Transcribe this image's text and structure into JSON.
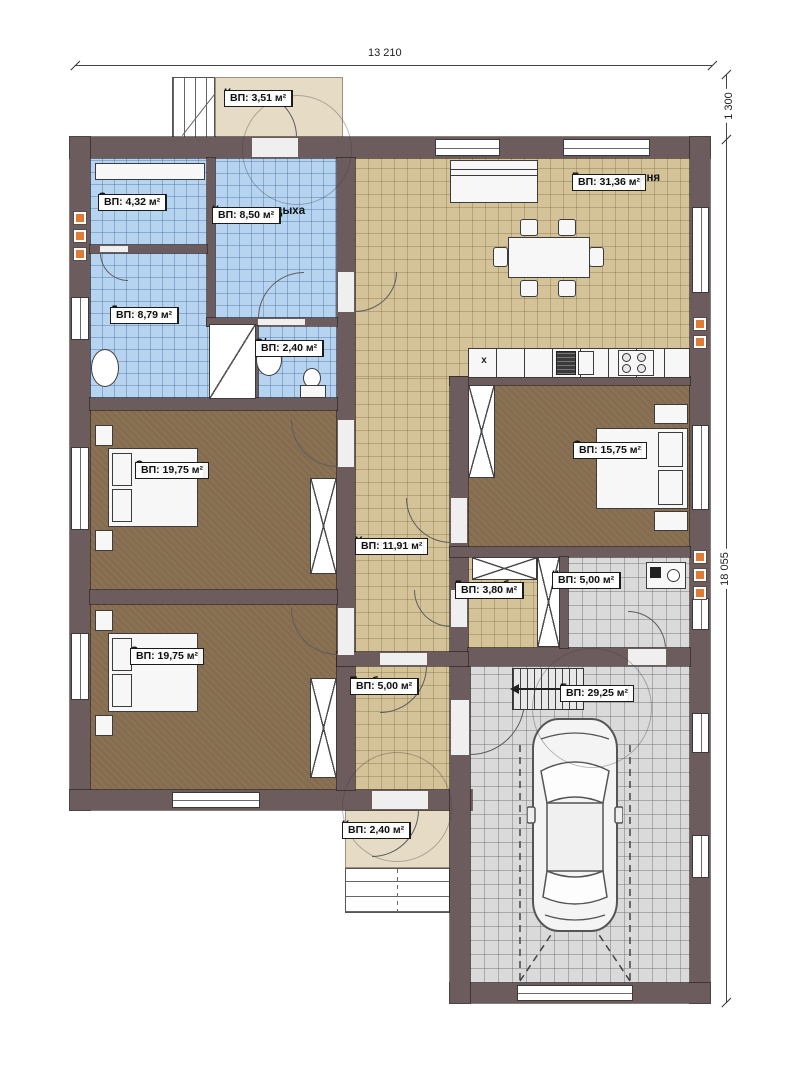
{
  "dims": {
    "top": "13 210",
    "right_top": "1 300",
    "right_main": "18 055"
  },
  "kitchen": {
    "counter_mark": "x"
  },
  "rooms": [
    {
      "name": "Крыльцо",
      "brand": "FixPlans.ru",
      "area": "ВП: 3,51 м²"
    },
    {
      "name": "Сауна",
      "brand": "FixPlans.ru",
      "area": "ВП: 4,32 м²"
    },
    {
      "name": "Комната отдыха",
      "brand": "FixPlans.ru",
      "area": "ВП: 8,50 м²"
    },
    {
      "name": "Душевая",
      "brand": "FixPlans.ru",
      "area": "ВП: 8,79 м²"
    },
    {
      "name": "С/у",
      "brand": "FixPlans.ru",
      "area": "ВП: 2,40 м²"
    },
    {
      "name": "Гостиная-кухня",
      "brand": "FixPlans.ru",
      "area": "ВП: 31,36 м²"
    },
    {
      "name": "Спальня",
      "brand": "FixPlans.ru",
      "area": "ВП: 19,75 м²"
    },
    {
      "name": "Холл",
      "brand": "FixPlans.ru",
      "area": "ВП: 11,91 м²"
    },
    {
      "name": "Спальня",
      "brand": "FixPlans.ru",
      "area": "ВП: 15,75 м²"
    },
    {
      "name": "Гардероб",
      "brand": "FixPlans.ru",
      "area": "ВП: 3,80 м²"
    },
    {
      "name": "Котельная",
      "brand": "FixPlans.ru",
      "area": "ВП: 5,00 м²"
    },
    {
      "name": "Спальня",
      "brand": "FixPlans.ru",
      "area": "ВП: 19,75 м²"
    },
    {
      "name": "Тамбур",
      "brand": "FixPlans.ru",
      "area": "ВП: 5,00 м²"
    },
    {
      "name": "Гараж",
      "brand": "FixPlans.ru",
      "area": "ВП: 29,25 м²"
    },
    {
      "name": "Крыльцо",
      "brand": "FixPlans.ru",
      "area": "ВП: 2,40 м²"
    }
  ],
  "colors": {
    "wall": "#6d5c5d",
    "tile_blue": "#b6d4f0",
    "tile_tan": "#d4c299",
    "carpet": "#8a7154",
    "tile_gray": "#dadada",
    "porch": "#e6dcc6",
    "vent": "#e07b35"
  }
}
